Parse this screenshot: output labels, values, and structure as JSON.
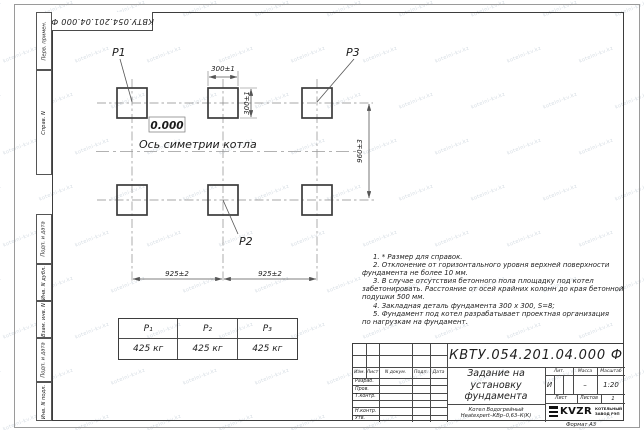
{
  "sheet": {
    "stamp_top_left": "КВТУ.054.201.04.000  Ф",
    "format_label": "Формат А3"
  },
  "colors": {
    "pad_outline": "#3b3b3b",
    "dimension_lines": "#555555",
    "centerlines": "#8a8a8a",
    "watermark": "#7d93a8"
  },
  "watermark": {
    "text": "kotelni-kv.kz"
  },
  "margin_strips": {
    "items": [
      "Перв. примен.",
      "Справ. N",
      "Подп. и дата",
      "Инв. N дубл.",
      "Взам. инв. N",
      "Подп. и дата",
      "Инв. N подл."
    ]
  },
  "drawing": {
    "pad_labels": {
      "p1": "P1",
      "p2": "P2",
      "p3": "P3"
    },
    "elevation_mark": "0.000",
    "axis_label": "Ось симетрии котла",
    "dimensions": {
      "pad_width": "300±1",
      "pad_height": "300±1",
      "row_spacing": "960±3",
      "col_spacing_left": "925±2",
      "col_spacing_right": "925±2"
    }
  },
  "loads_table": {
    "headers": [
      "P₁",
      "P₂",
      "P₃"
    ],
    "values": [
      "425 кг",
      "425 кг",
      "425 кг"
    ]
  },
  "notes": {
    "lines": [
      "1. * Размер для справок.",
      "2. Отклонение от горизонтального уровня верхней поверхности",
      "фундамента не более 10 мм.",
      "3. В случае отсутствия бетонного пола площадку под котел",
      "забетонировать. Расстояние от осей крайних колонн до края бетонной",
      "подушки 500 мм.",
      "4. Закладная деталь фундамента  300 х 300, S=8;",
      "5. Фундамент под котел разрабатывает проектная организация",
      "по нагрузкам на фундамент."
    ]
  },
  "title_block": {
    "doc_number": "КВТУ.054.201.04.000  Ф",
    "title_lines": [
      "Задание на",
      "установку",
      "фундамента"
    ],
    "product_lines": [
      "Котел Водогрейный",
      "Heatexpert–КВр–0,63–К(К)"
    ],
    "header_cells": [
      "Изм.",
      "Лист",
      "N докум.",
      "Подп.",
      "Дата"
    ],
    "sign_rows": [
      "Разраб.",
      "Пров.",
      "Т.контр.",
      "",
      "Н.контр.",
      "Утв."
    ],
    "lit_label": "Лит.",
    "lit_value": "И",
    "mass_label": "Масса",
    "mass_value": "–",
    "scale_label": "Масштаб",
    "scale_value": "1:20",
    "sheet_label": "Лист",
    "sheets_label": "Листов",
    "sheets_value": "1",
    "logo_text": "KVZR",
    "logo_sub_lines": [
      "КОТЕЛЬНЫЙ",
      "ЗАВОД РЭП"
    ]
  }
}
